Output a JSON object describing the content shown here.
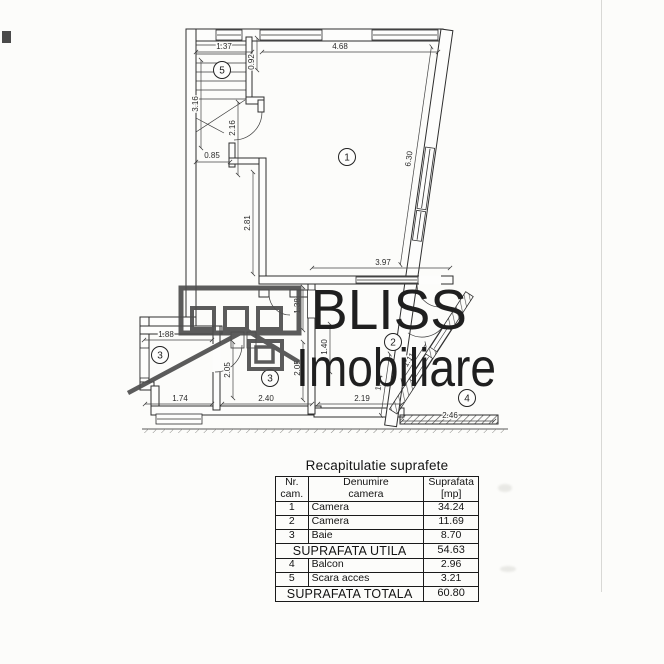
{
  "logo": {
    "line1": "BLISS",
    "line2": "Imobiliare"
  },
  "plan": {
    "rooms": {
      "r1": "1",
      "r2": "2",
      "r3a": "3",
      "r3b": "3",
      "r4": "4",
      "r5": "5"
    },
    "dims": {
      "w137": "1.37",
      "w468": "4.68",
      "h092": "0.92",
      "h316": "3.16",
      "h216": "2.16",
      "w085": "0.85",
      "h281": "2.81",
      "w397": "3.97",
      "h138": "1.38",
      "w188": "1.88",
      "h205a": "2.05",
      "h205b": "2.05",
      "h140": "1.40",
      "d111": "1.11",
      "w174": "1.74",
      "w240": "2.40",
      "w219": "2.19",
      "w246": "2.46",
      "d630": "6.30",
      "d144": "1.44"
    }
  },
  "table": {
    "title": "Recapitulatie suprafete",
    "header": {
      "col1a": "Nr.",
      "col1b": "cam.",
      "col2a": "Denumire",
      "col2b": "camera",
      "col3a": "Suprafata",
      "col3b": "[mp]"
    },
    "rows": [
      {
        "nr": "1",
        "name": "Camera",
        "area": "34.24"
      },
      {
        "nr": "2",
        "name": "Camera",
        "area": "11.69"
      },
      {
        "nr": "3",
        "name": "Baie",
        "area": "8.70"
      }
    ],
    "subtotal": {
      "label": "SUPRAFATA UTILA",
      "value": "54.63"
    },
    "rows2": [
      {
        "nr": "4",
        "name": "Balcon",
        "area": "2.96"
      },
      {
        "nr": "5",
        "name": "Scara acces",
        "area": "3.21"
      }
    ],
    "total": {
      "label": "SUPRAFATA TOTALA",
      "value": "60.80"
    }
  }
}
